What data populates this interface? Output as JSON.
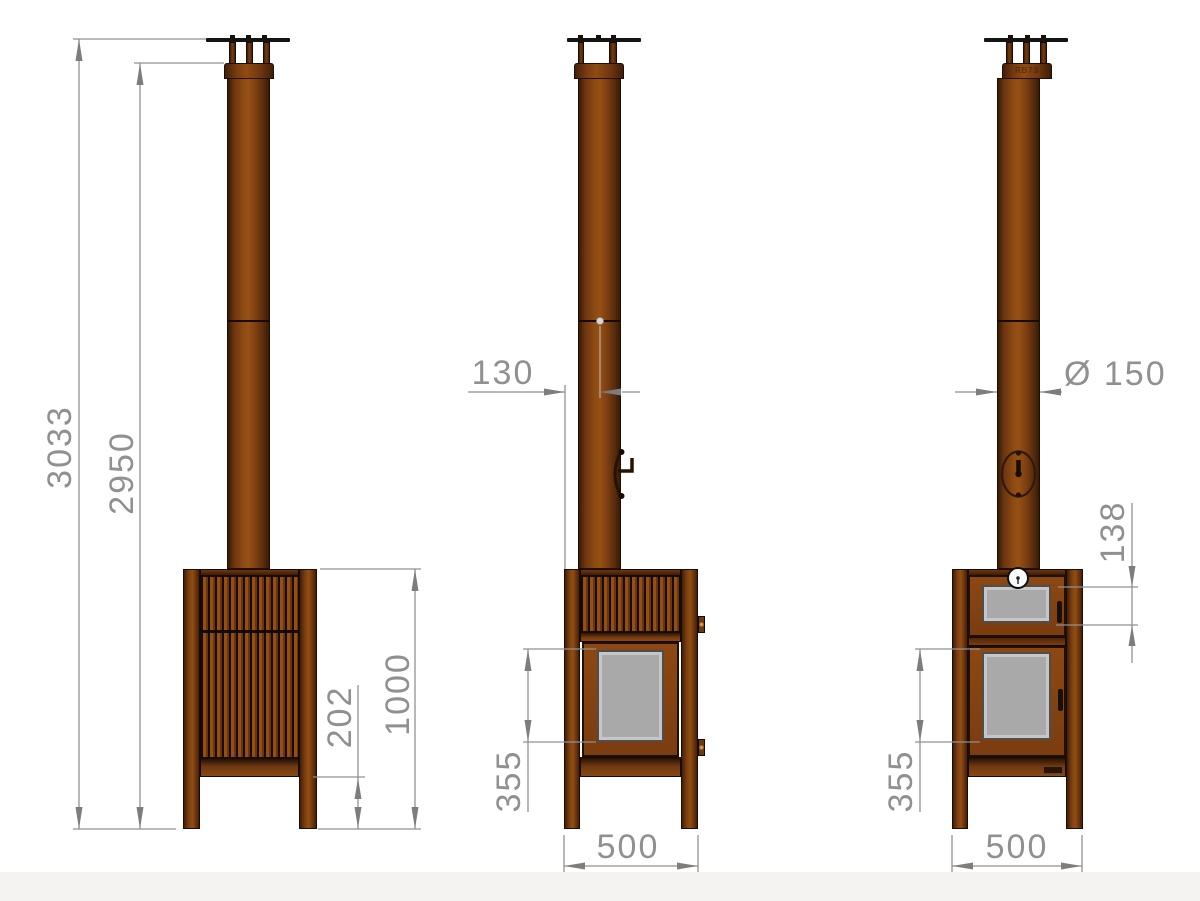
{
  "brand_mark": "RB73",
  "dims": {
    "side_total_height": "3033",
    "side_flue_height": "2950",
    "side_body_height": "1000",
    "side_under_body": "202",
    "front_flue_offset": "130",
    "front_glass_height": "355",
    "front_width": "500",
    "back_flue_diameter": "Ø 150",
    "back_oven_glass_height": "138",
    "back_glass_height": "355",
    "back_width": "500"
  },
  "colors": {
    "corten_brown": "#8a4513",
    "dimension_gray": "#909090",
    "glass_gray": "#a9a9a9",
    "background": "#ffffff"
  }
}
